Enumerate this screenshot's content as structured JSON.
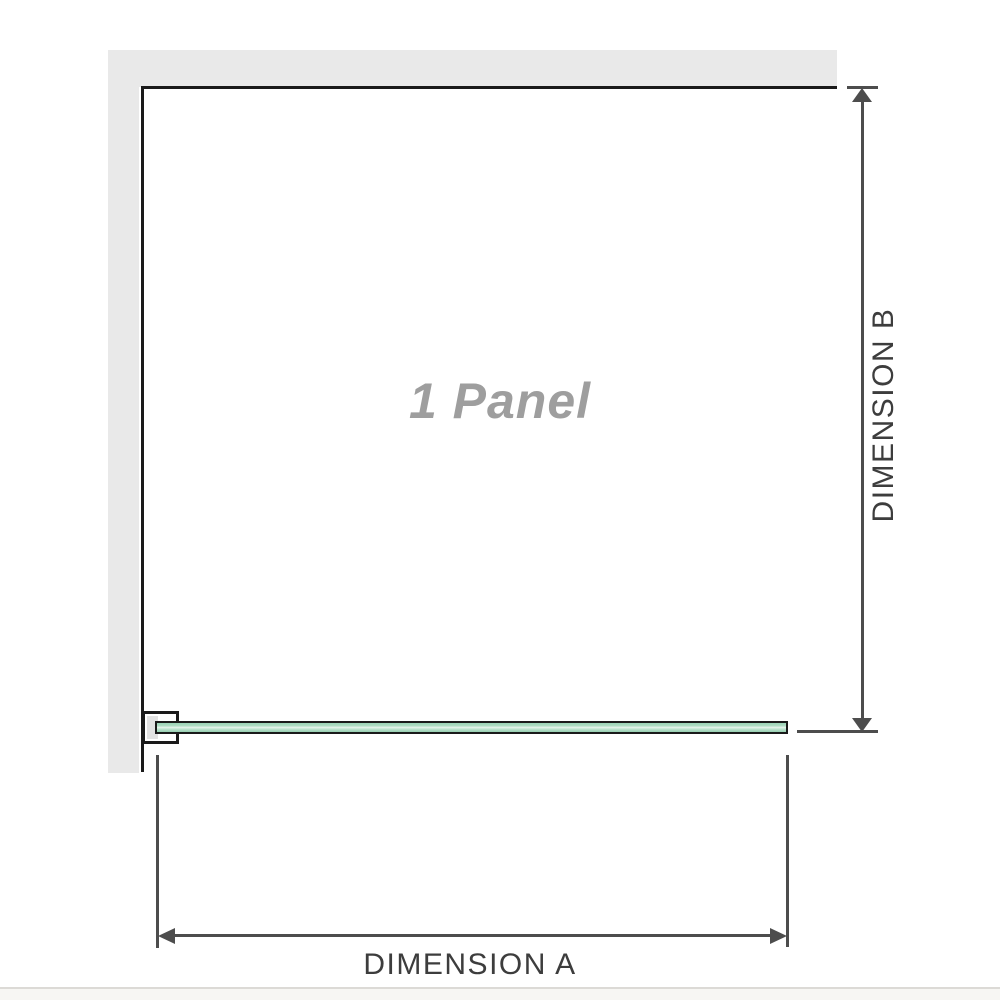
{
  "panel": {
    "label": "1 Panel"
  },
  "dimensions": {
    "a": {
      "label": "DIMENSION A"
    },
    "b": {
      "label": "DIMENSION B"
    }
  },
  "colors": {
    "wall": "#e9e9e9",
    "outline": "#1a1a1a",
    "dimension_line": "#4d4d4d",
    "dimension_text": "#3d3d3d",
    "panel_text": "#9e9e9e",
    "glass_green": "#9bd3b6",
    "glass_highlight": "#e9f5ee",
    "bracket_fill": "#e2e2e2",
    "footer_line": "#dcdad6",
    "footer_strip": "#f7f6f3"
  }
}
